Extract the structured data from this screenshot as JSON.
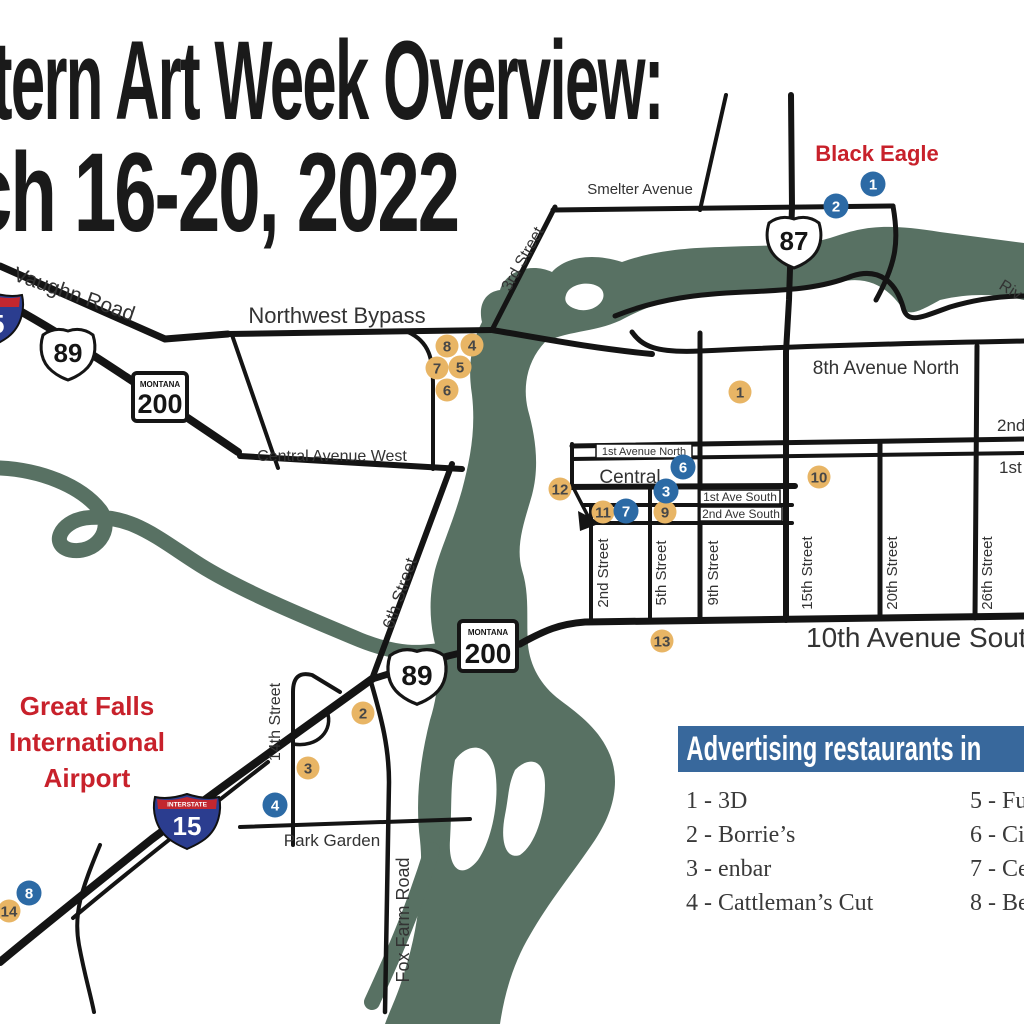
{
  "title": {
    "line1": "tern Art Week Overview:",
    "line2": "ch 16-20, 2022"
  },
  "labels": {
    "smelter_avenue": "Smelter Avenue",
    "black_eagle": "Black Eagle",
    "river_partial": "Riv",
    "vaughn_road": "Vaughn Road",
    "northwest_bypass": "Northwest Bypass",
    "third_street": "3rd Street",
    "central_avenue_west": "Central Avenue West",
    "sixth_street": "6th Street",
    "eighth_avenue_north": "8th Avenue North",
    "first_avenue_north": "1st Avenue North",
    "central": "Central",
    "first_ave_south": "1st Ave South",
    "second_ave_south": "2nd Ave South",
    "second_partial": "2nd",
    "first_partial": "1st",
    "second_street": "2nd Street",
    "fifth_street": "5th Street",
    "ninth_street": "9th Street",
    "fifteenth_street": "15th Street",
    "twentieth_street": "20th Street",
    "twentysixth_street": "26th Street",
    "tenth_avenue_south": "10th Avenue South",
    "fourteenth_street": "14th Street",
    "park_garden": "Park Garden",
    "fox_farm_road": "Fox Farm Road",
    "airport_line1": "Great Falls",
    "airport_line2": "International",
    "airport_line3": "Airport"
  },
  "shields": {
    "us87": "87",
    "us89": "89",
    "mt_state": "MONTANA",
    "mt200": "200",
    "interstate_label": "INTERSTATE",
    "i15": "15"
  },
  "markers": {
    "orange_color": "#e8b565",
    "blue_color": "#2c6aa5",
    "items": [
      {
        "n": "8",
        "type": "orange",
        "x": 447,
        "y": 346
      },
      {
        "n": "4",
        "type": "orange",
        "x": 472,
        "y": 345
      },
      {
        "n": "7",
        "type": "orange",
        "x": 437,
        "y": 368
      },
      {
        "n": "5",
        "type": "orange",
        "x": 460,
        "y": 367
      },
      {
        "n": "6",
        "type": "orange",
        "x": 447,
        "y": 390
      },
      {
        "n": "1",
        "type": "orange",
        "x": 740,
        "y": 392
      },
      {
        "n": "10",
        "type": "orange",
        "x": 819,
        "y": 477
      },
      {
        "n": "12",
        "type": "orange",
        "x": 560,
        "y": 489
      },
      {
        "n": "11",
        "type": "orange",
        "x": 603,
        "y": 512
      },
      {
        "n": "9",
        "type": "orange",
        "x": 665,
        "y": 512
      },
      {
        "n": "13",
        "type": "orange",
        "x": 662,
        "y": 641
      },
      {
        "n": "2",
        "type": "orange",
        "x": 363,
        "y": 713
      },
      {
        "n": "3",
        "type": "orange",
        "x": 308,
        "y": 768
      },
      {
        "n": "14",
        "type": "orange",
        "x": 9,
        "y": 911
      },
      {
        "n": "1",
        "type": "blue",
        "x": 873,
        "y": 184
      },
      {
        "n": "2",
        "type": "blue",
        "x": 836,
        "y": 206
      },
      {
        "n": "6",
        "type": "blue",
        "x": 683,
        "y": 467
      },
      {
        "n": "3",
        "type": "blue",
        "x": 666,
        "y": 491
      },
      {
        "n": "7",
        "type": "blue",
        "x": 626,
        "y": 511
      },
      {
        "n": "4",
        "type": "blue",
        "x": 275,
        "y": 805
      },
      {
        "n": "8",
        "type": "blue",
        "x": 29,
        "y": 893
      }
    ]
  },
  "legend": {
    "header": "Advertising restaurants in",
    "left_items": [
      "1 - 3D",
      "2 - Borrie’s",
      "3 - enbar",
      "4 - Cattleman’s Cut"
    ],
    "right_items": [
      "5 - Fu",
      "6 - Ci",
      "7 - Ce",
      "8 - Be"
    ]
  },
  "colors": {
    "river": "#587163",
    "road": "#141414",
    "ink": "#2e2e2e",
    "red": "#c8212b",
    "legend_blue": "#38689c",
    "i_blue": "#2b3d8f",
    "i_red": "#c2272f"
  }
}
